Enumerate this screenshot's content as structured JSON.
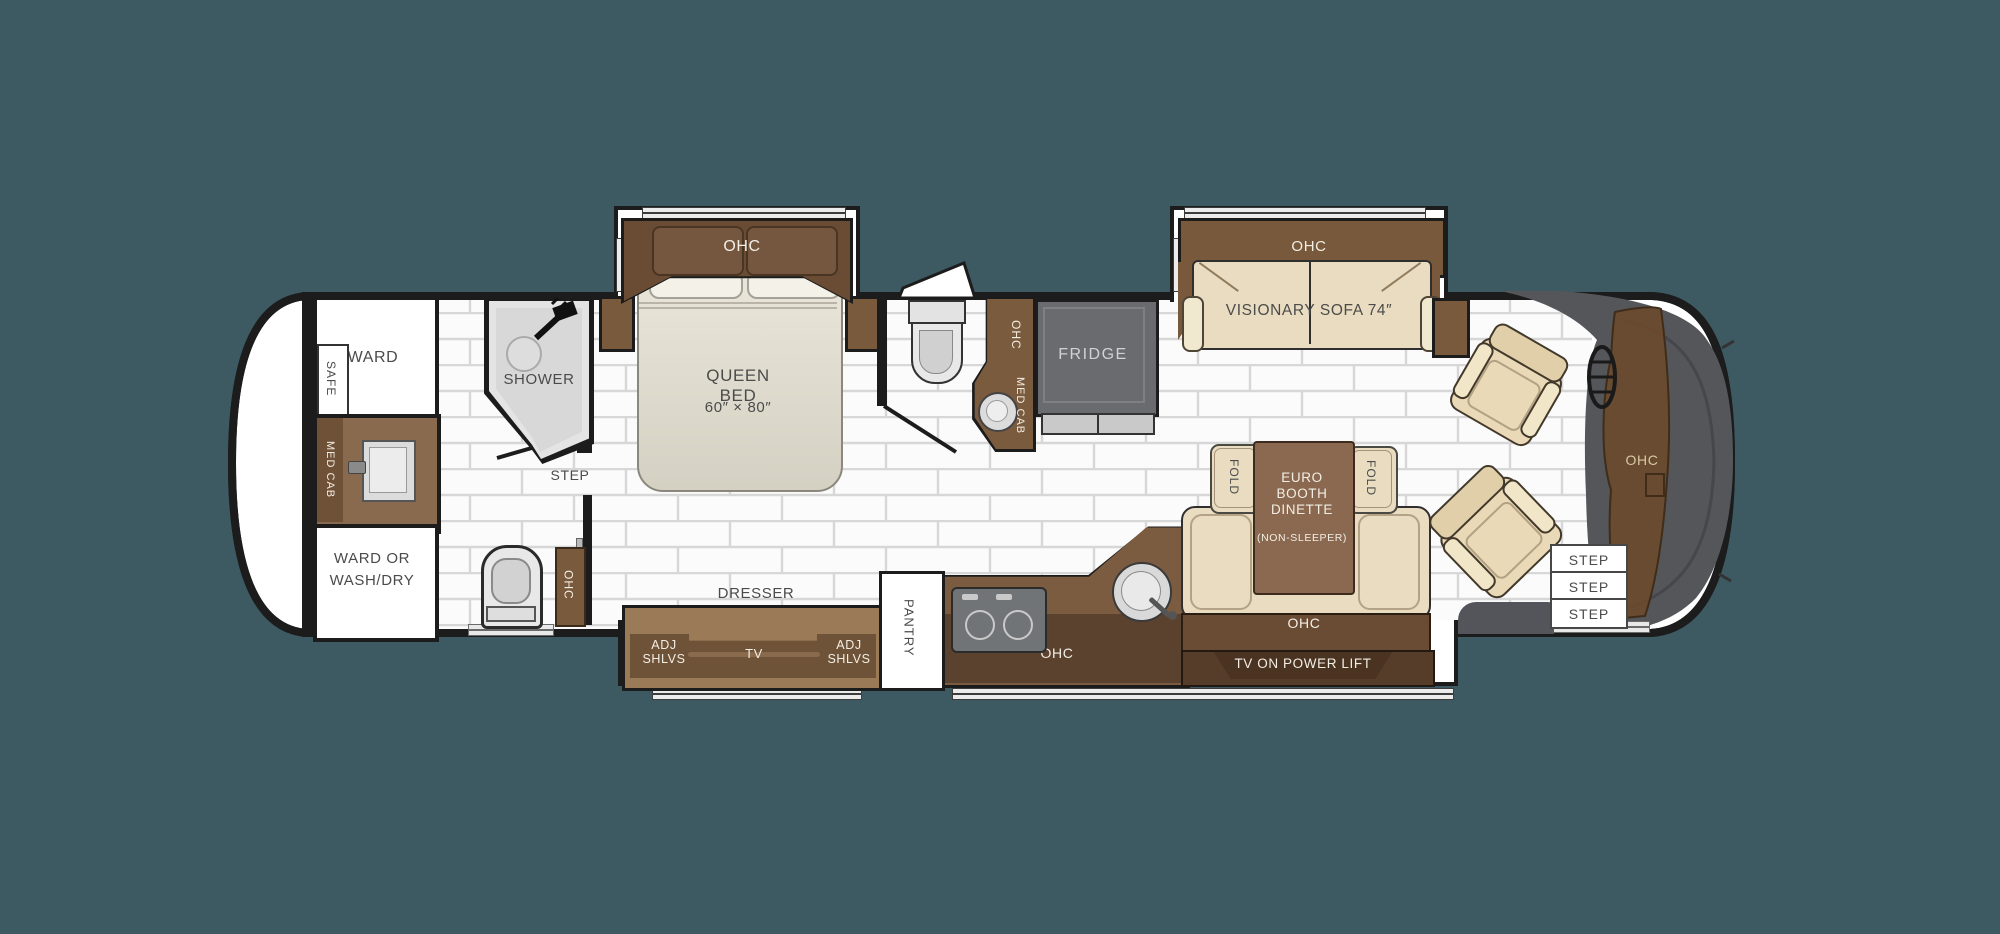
{
  "colors": {
    "background": "#3D5962",
    "wall": "#1C1C1C",
    "cabinet_dark_brown": "#6A4C35",
    "cabinet_medium_brown": "#7B5C41",
    "cabinet_light_brown": "#9B7A58",
    "upholstery_beige": "#EAD9B6",
    "cockpit_gray": "#54565A",
    "fridge_gray": "#696B6E",
    "tile_grout": "#D7D7D7"
  },
  "rear_bath": {
    "ward": "WARD",
    "safe": "SAFE",
    "med_cab": "MED CAB",
    "ward_or_wash_line1": "WARD OR",
    "ward_or_wash_line2": "WASH/DRY",
    "shower": "SHOWER",
    "step": "STEP",
    "ohc": "OHC"
  },
  "bedroom": {
    "ohc": "OHC",
    "bed_name": "QUEEN BED",
    "bed_size": "60″ × 80″",
    "dresser": "DRESSER",
    "adj_shlvs_left_line1": "ADJ",
    "adj_shlvs_left_line2": "SHLVS",
    "tv": "TV",
    "adj_shlvs_right_line1": "ADJ",
    "adj_shlvs_right_line2": "SHLVS"
  },
  "half_bath": {
    "ohc": "OHC",
    "med_cab": "MED CAB"
  },
  "kitchen": {
    "pantry": "PANTRY",
    "fridge": "FRIDGE",
    "ohc": "OHC"
  },
  "dinette": {
    "fold_left": "FOLD",
    "fold_right": "FOLD",
    "title_line1": "EURO",
    "title_line2": "BOOTH",
    "title_line3": "DINETTE",
    "subtitle": "(NON-SLEEPER)",
    "ohc": "OHC",
    "tv_lift": "TV ON POWER LIFT"
  },
  "living": {
    "ohc": "OHC",
    "sofa": "VISIONARY SOFA 74″"
  },
  "front": {
    "ohc": "OHC",
    "steps": [
      "STEP",
      "STEP",
      "STEP"
    ]
  }
}
